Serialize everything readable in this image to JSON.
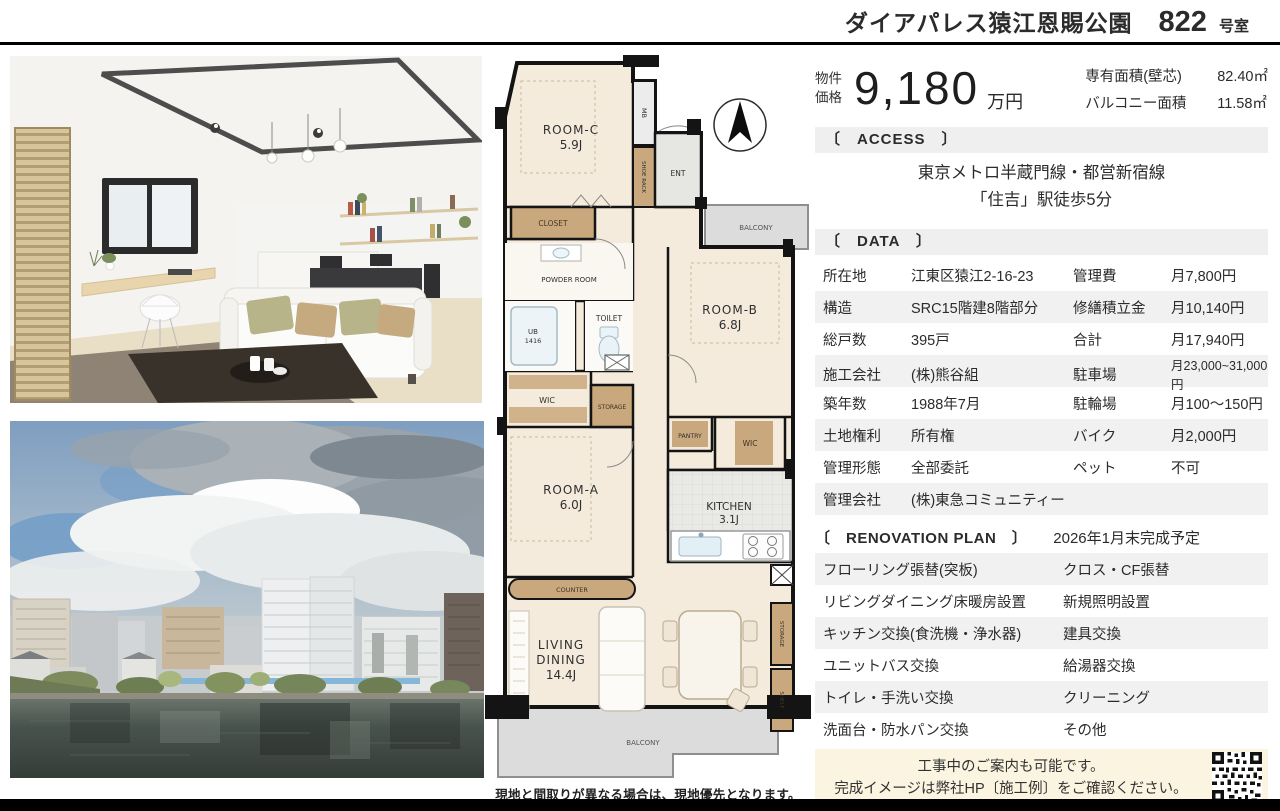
{
  "header": {
    "building_name": "ダイアパレス猿江恩賜公園",
    "room_number": "822",
    "room_suffix": "号室"
  },
  "price": {
    "label_line1": "物件",
    "label_line2": "価格",
    "amount": "9,180",
    "unit": "万円",
    "area1_label": "専有面積(壁芯)",
    "area1_value": "82.40㎡",
    "area2_label": "バルコニー面積",
    "area2_value": "11.58㎡"
  },
  "access": {
    "heading": "〔　ACCESS　〕",
    "line1": "東京メトロ半蔵門線・都営新宿線",
    "line2": "「住吉」駅徒歩5分"
  },
  "data_section": {
    "heading": "〔　DATA　〕",
    "rows": [
      {
        "l1": "所在地",
        "v1": "江東区猿江2-16-23",
        "l2": "管理費",
        "v2": "月7,800円"
      },
      {
        "l1": "構造",
        "v1": "SRC15階建8階部分",
        "l2": "修繕積立金",
        "v2": "月10,140円"
      },
      {
        "l1": "総戸数",
        "v1": "395戸",
        "l2": "合計",
        "v2": "月17,940円"
      },
      {
        "l1": "施工会社",
        "v1": "(株)熊谷組",
        "l2": "駐車場",
        "v2": "月23,000~31,000円"
      },
      {
        "l1": "築年数",
        "v1": "1988年7月",
        "l2": "駐輪場",
        "v2": "月100〜150円"
      },
      {
        "l1": "土地権利",
        "v1": "所有権",
        "l2": "バイク",
        "v2": "月2,000円"
      },
      {
        "l1": "管理形態",
        "v1": "全部委託",
        "l2": "ペット",
        "v2": "不可"
      },
      {
        "l1": "管理会社",
        "v1": "(株)東急コミュニティー",
        "l2": "",
        "v2": ""
      }
    ]
  },
  "renovation": {
    "heading": "〔　RENOVATION PLAN　〕",
    "completion": "2026年1月末完成予定",
    "rows": [
      {
        "left": "フローリング張替(突板)",
        "right": "クロス・CF張替"
      },
      {
        "left": "リビングダイニング床暖房設置",
        "right": "新規照明設置"
      },
      {
        "left": "キッチン交換(食洗機・浄水器)",
        "right": "建具交換"
      },
      {
        "left": "ユニットバス交換",
        "right": "給湯器交換"
      },
      {
        "left": "トイレ・手洗い交換",
        "right": "クリーニング"
      },
      {
        "left": "洗面台・防水パン交換",
        "right": "その他"
      }
    ]
  },
  "note": {
    "line1": "工事中のご案内も可能です。",
    "line2": "完成イメージは弊社HP〔施工例〕をご確認ください。"
  },
  "floorplan": {
    "caption": "現地と間取りが異なる場合は、現地優先となります。",
    "labels": {
      "room_c": "ROOM-C",
      "room_c_size": "5.9J",
      "mb": "MB",
      "shoe_rack": "SHOE RACK",
      "ent": "ENT",
      "closet": "CLOSET",
      "balcony_top": "BALCONY",
      "powder_room": "POWDER ROOM",
      "ub": "UB",
      "ub_size": "1416",
      "toilet": "TOILET",
      "wic_left": "WIC",
      "storage_mid": "STORAGE",
      "room_b": "ROOM-B",
      "room_b_size": "6.8J",
      "pantry": "PANTRY",
      "wic_right": "WIC",
      "room_a": "ROOM-A",
      "room_a_size": "6.0J",
      "counter": "COUNTER",
      "kitchen": "KITCHEN",
      "kitchen_size": "3.1J",
      "living_line1": "LIVING",
      "living_line2": "DINING",
      "living_size": "14.4J",
      "storage_right": "STORAGE",
      "shelf": "SHELF",
      "balcony_bottom": "BALCONY"
    }
  },
  "colors": {
    "rule": "#000000",
    "bar_bg": "#efefef",
    "row_alt": "#f1f1f1",
    "note_bg": "#fbf4e1",
    "floor": "#f4ebdc",
    "tan": "#c9a87d",
    "balcony": "#dcdcdc",
    "wall": "#141414"
  }
}
